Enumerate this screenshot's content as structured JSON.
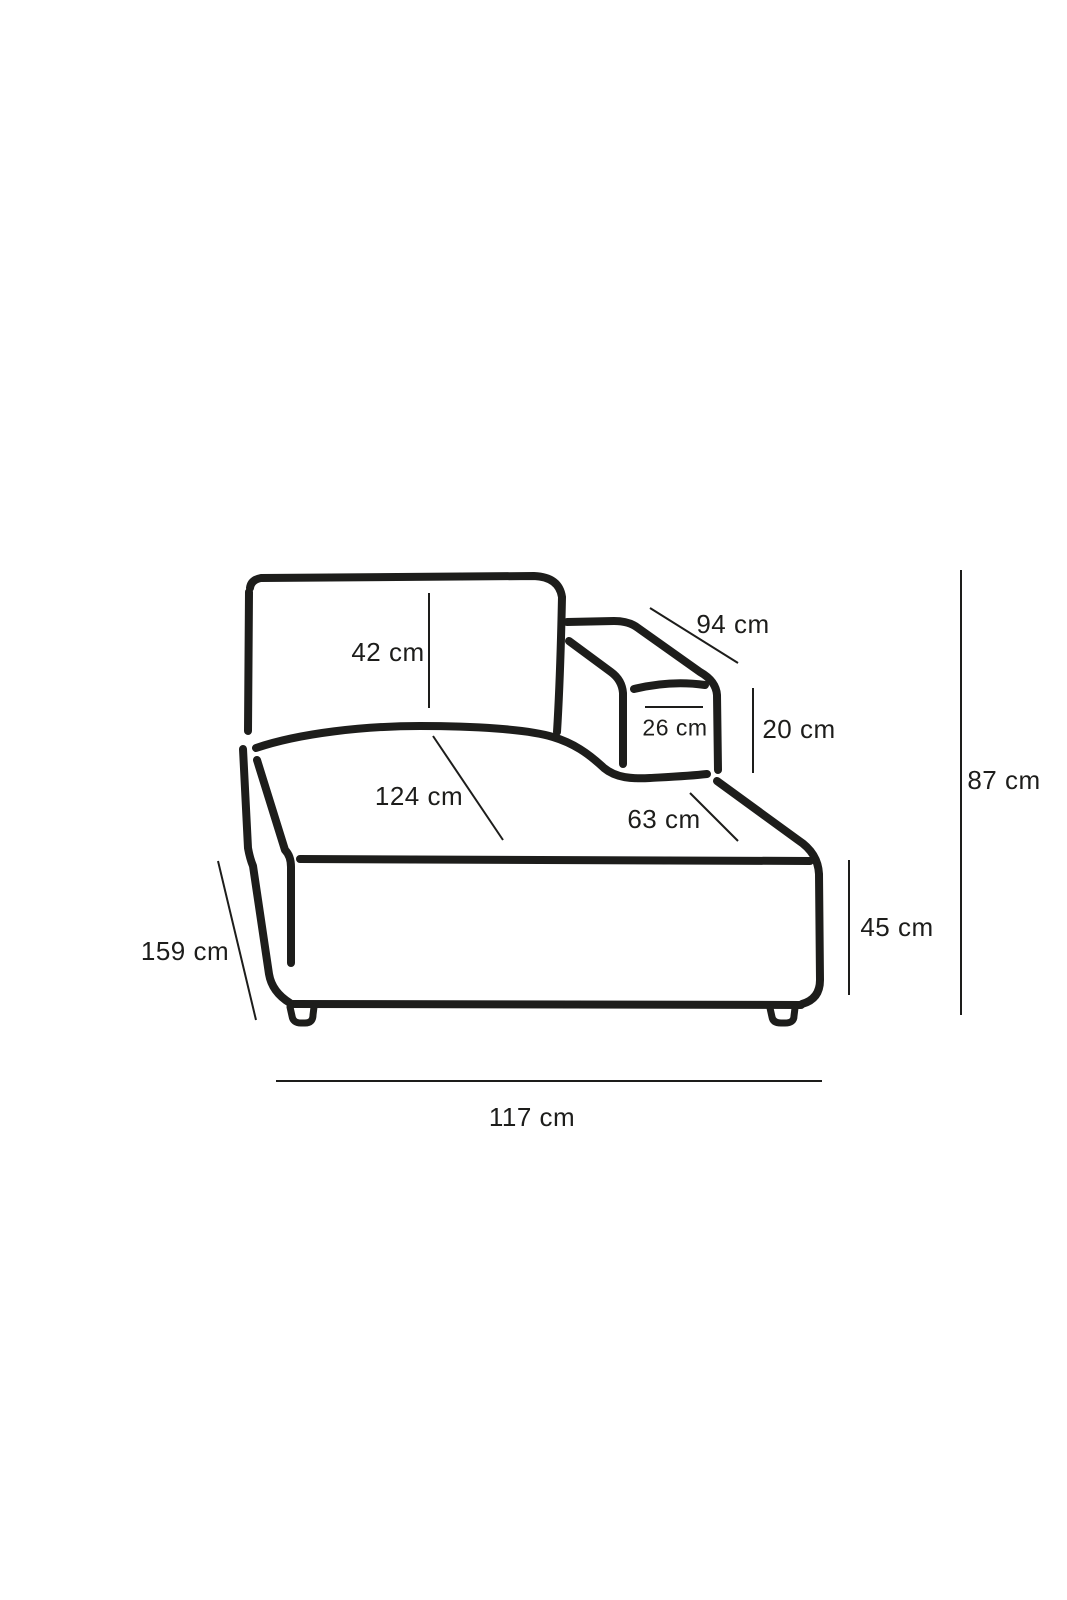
{
  "figure": {
    "kind": "product-dimension-line-drawing",
    "subject": "sofa chaise module with right armrest, three-quarter view",
    "unit": "cm",
    "ink_color": "#1d1d1b",
    "background_color": "#ffffff",
    "measurements": {
      "backrest_height": "42 cm",
      "armrest_length": "94 cm",
      "armrest_top_width": "26 cm",
      "armrest_height_above_seat": "20 cm",
      "overall_height": "87 cm",
      "seat_length": "124 cm",
      "right_seat_width": "63 cm",
      "seat_base_height": "45 cm",
      "overall_depth": "159 cm",
      "overall_width": "117 cm"
    }
  }
}
